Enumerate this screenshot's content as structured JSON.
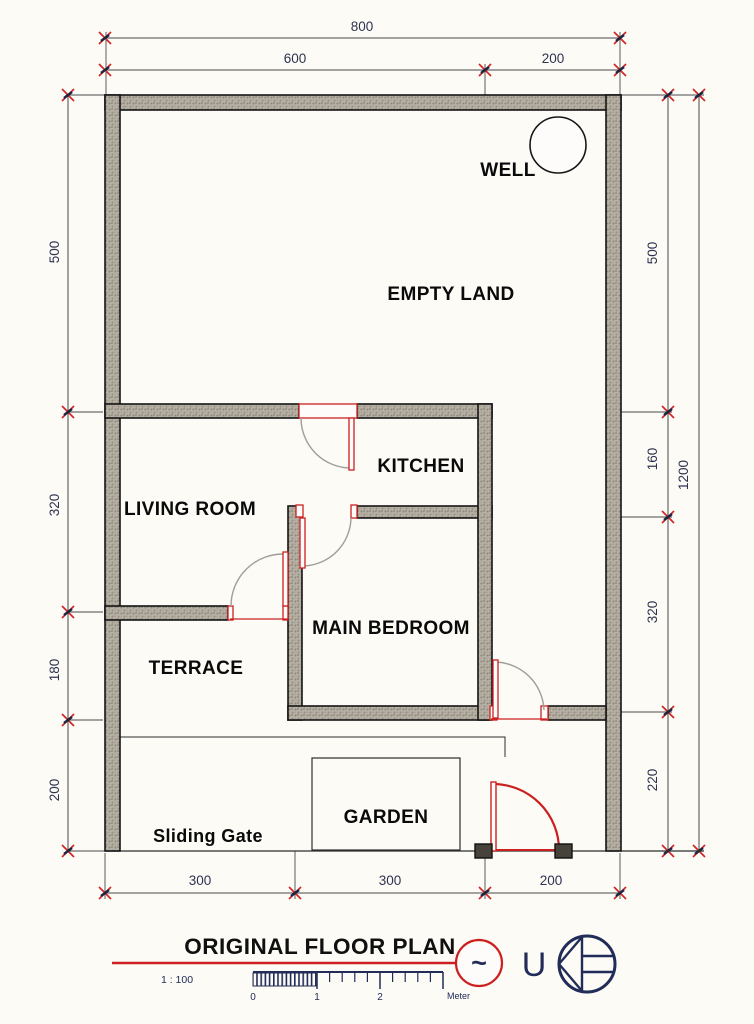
{
  "plan": {
    "rooms": {
      "empty_land": "EMPTY LAND",
      "well": "WELL",
      "kitchen": "KITCHEN",
      "living_room": "LIVING ROOM",
      "main_bedroom": "MAIN BEDROOM",
      "terrace": "TERRACE",
      "garden": "GARDEN",
      "sliding_gate": "Sliding Gate"
    },
    "dimensions": {
      "top_overall": "800",
      "top": [
        "600",
        "200"
      ],
      "bottom": [
        "300",
        "300",
        "200"
      ],
      "left": [
        "500",
        "320",
        "180",
        "200"
      ],
      "right": [
        "500",
        "160",
        "320",
        "220"
      ],
      "right_overall": "1200"
    }
  },
  "title_block": {
    "title": "ORIGINAL FLOOR PLAN",
    "scale_ratio": "1 : 100",
    "scale_numbers": [
      "0",
      "1",
      "2"
    ],
    "scale_unit": "Meter",
    "north_letter": "U",
    "symbol_tilde": "~"
  },
  "colors": {
    "wall_fill": "#b4aea3",
    "accent_red": "#cc2020",
    "drafting_navy": "#222c58",
    "line_black": "#1a1a1a",
    "paper": "#fcfbf6"
  }
}
